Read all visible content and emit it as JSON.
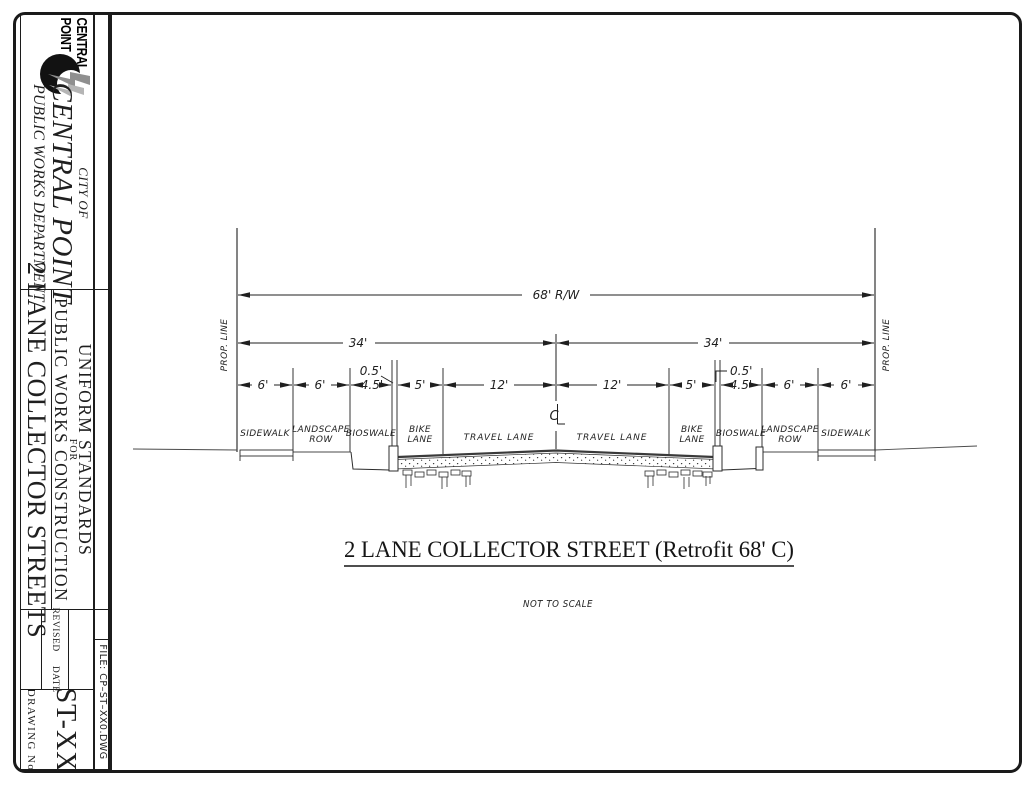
{
  "sheet": {
    "paper": "#ffffff",
    "ink": "#1f1f1f"
  },
  "title_block": {
    "logo": {
      "word1": "CENTRAL",
      "word2": "POINT"
    },
    "agency": {
      "city_of": "CITY OF",
      "city_name": "CENTRAL POINT",
      "department": "PUBLIC WORKS DEPARTMENT"
    },
    "sheet_category": "2 LANE COLLECTOR STREETS",
    "standards": {
      "line1": "UNIFORM STANDARDS",
      "line2": "FOR",
      "line3": "PUBLIC WORKS CONSTRUCTION"
    },
    "revision": {
      "revised": "REVISED",
      "date": "DATE"
    },
    "file_label": "FILE:  CP–ST–XX0.DWG",
    "drawing_no_label": "DRAWING No",
    "drawing_number": "ST-XX"
  },
  "drawing": {
    "sheet_title": "2 LANE COLLECTOR STREET (Retrofit 68' C)",
    "scale_note": "NOT TO SCALE",
    "prop_line": "PROP. LINE",
    "right_of_way": "68' R/W",
    "half_width_left": "34'",
    "half_width_right": "34'",
    "curb_left": "0.5'",
    "curb_right": "0.5'",
    "centerline_c": "C",
    "chain": [
      "6'",
      "6'",
      "4.5'",
      "5'",
      "12'",
      "12'",
      "5'",
      "4.5'",
      "6'",
      "6'"
    ],
    "zones": [
      {
        "l1": "SIDEWALK"
      },
      {
        "l1": "LANDSCAPE",
        "l2": "ROW"
      },
      {
        "l1": "BIOSWALE"
      },
      {
        "l1": "BIKE",
        "l2": "LANE"
      },
      {
        "l1": "TRAVEL LANE"
      },
      {
        "l1": "TRAVEL LANE"
      },
      {
        "l1": "BIKE",
        "l2": "LANE"
      },
      {
        "l1": "BIOSWALE"
      },
      {
        "l1": "LANDSCAPE",
        "l2": "ROW"
      },
      {
        "l1": "SIDEWALK"
      }
    ]
  }
}
